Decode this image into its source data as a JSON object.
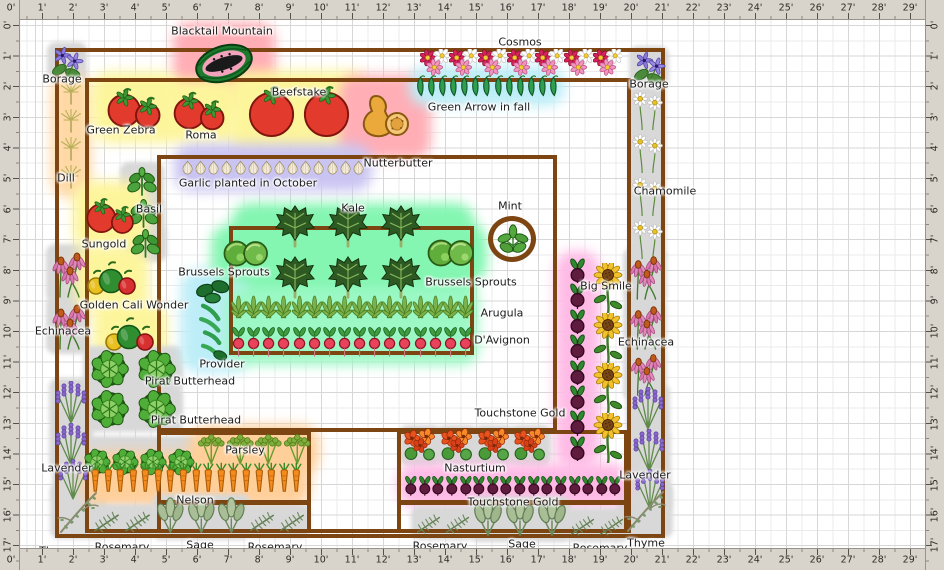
{
  "rulers": {
    "unit": "feet",
    "top": [
      "0'",
      "1'",
      "2'",
      "3'",
      "4'",
      "5'",
      "6'",
      "7'",
      "8'",
      "9'",
      "10'",
      "11'",
      "12'",
      "13'",
      "14'",
      "15'",
      "16'",
      "17'",
      "18'",
      "19'",
      "20'",
      "21'",
      "22'",
      "23'",
      "24'",
      "25'",
      "26'",
      "27'",
      "28'",
      "29'"
    ],
    "bottom": [
      "0'",
      "1'",
      "2'",
      "3'",
      "4'",
      "5'",
      "6'",
      "7'",
      "8'",
      "9'",
      "10'",
      "11'",
      "12'",
      "13'",
      "14'",
      "15'",
      "16'",
      "17'",
      "18'",
      "19'",
      "20'",
      "21'",
      "22'",
      "23'",
      "24'",
      "25'",
      "26'",
      "27'",
      "28'",
      "29'"
    ],
    "left": [
      "0'",
      "1'",
      "2'",
      "3'",
      "4'",
      "5'",
      "6'",
      "7'",
      "8'",
      "9'",
      "10'",
      "11'",
      "12'",
      "13'",
      "14'",
      "15'",
      "16'",
      "17'"
    ],
    "right": [
      "0'",
      "1'",
      "2'",
      "3'",
      "4'",
      "5'",
      "6'",
      "7'",
      "8'",
      "9'",
      "10'",
      "11'",
      "12'",
      "13'",
      "14'",
      "15'",
      "16'",
      "17'"
    ]
  },
  "colors": {
    "bed_border": "#7c4512",
    "ruler_bg": "#d8d4cb",
    "grid_minor": "#ebebeb",
    "grid_major": "#d7d7d7",
    "label_text": "#1c1c1c",
    "footprint": "#d8d8d8"
  },
  "beds": [
    {
      "name": "outer-bed",
      "x": 55,
      "y": 48,
      "w": 610,
      "h": 490
    },
    {
      "name": "main-bed",
      "x": 85,
      "y": 78,
      "w": 546,
      "h": 455
    },
    {
      "name": "center-bed",
      "x": 157,
      "y": 155,
      "w": 400,
      "h": 277
    },
    {
      "name": "salad-bed",
      "x": 229,
      "y": 226,
      "w": 245,
      "h": 129
    },
    {
      "name": "carrot-parsley-bed",
      "x": 157,
      "y": 431,
      "w": 154,
      "h": 102
    },
    {
      "name": "nasturtium-bed",
      "x": 397,
      "y": 430,
      "w": 231,
      "h": 103
    },
    {
      "name": "mint-pot",
      "x": 488,
      "y": 216,
      "w": 48,
      "h": 46,
      "shape": "circle"
    },
    {
      "name": "bed-divider",
      "x": 157,
      "y": 500,
      "w": 154,
      "h": 5,
      "shape": "line"
    },
    {
      "name": "bed-divider",
      "x": 397,
      "y": 500,
      "w": 231,
      "h": 5,
      "shape": "line"
    }
  ],
  "zones": [
    {
      "name": "kale-zone",
      "x": 232,
      "y": 203,
      "w": 242,
      "h": 102,
      "color": "#84f6b2"
    }
  ],
  "plants": [
    {
      "name": "borage",
      "icon": "borage",
      "x": 50,
      "y": 45,
      "w": 34,
      "h": 36,
      "fp": 1
    },
    {
      "name": "dill",
      "icon": "dill",
      "x": 57,
      "y": 80,
      "w": 28,
      "h": 112,
      "count": 4,
      "dir": "v",
      "glow": "#ffd8a6",
      "gp": 6
    },
    {
      "name": "echinacea",
      "icon": "echinacea",
      "x": 49,
      "y": 247,
      "w": 38,
      "h": 52,
      "fp": 1
    },
    {
      "name": "echinacea",
      "icon": "echinacea",
      "x": 49,
      "y": 299,
      "w": 38,
      "h": 52,
      "fp": 1
    },
    {
      "name": "lavender",
      "icon": "lavender",
      "x": 52,
      "y": 381,
      "w": 38,
      "h": 44,
      "fp": 1
    },
    {
      "name": "lavender",
      "icon": "lavender",
      "x": 52,
      "y": 423,
      "w": 38,
      "h": 44,
      "fp": 1
    },
    {
      "name": "lavender",
      "icon": "lavender",
      "x": 55,
      "y": 459,
      "w": 36,
      "h": 42,
      "fp": 1
    },
    {
      "name": "thyme",
      "icon": "thyme",
      "x": 53,
      "y": 486,
      "w": 50,
      "h": 50,
      "fp": 1
    },
    {
      "name": "blacktail-mountain-watermelon",
      "icon": "watermelon",
      "x": 190,
      "y": 39,
      "w": 68,
      "h": 49,
      "glow": "#ffaeb6",
      "gp": 17
    },
    {
      "name": "green-zebra-tomatoes",
      "icon": "tomato2",
      "x": 102,
      "y": 83,
      "w": 66,
      "h": 49,
      "glow": "#fdf59c",
      "gp": 11
    },
    {
      "name": "roma-tomatoes",
      "icon": "tomato2",
      "x": 169,
      "y": 87,
      "w": 62,
      "h": 47,
      "glow": "#fdf59c",
      "gp": 8
    },
    {
      "name": "beefstake-tomatoes",
      "icon": "tomato2big",
      "x": 242,
      "y": 84,
      "w": 114,
      "h": 55,
      "glow": "#fdf59c",
      "gp": 13
    },
    {
      "name": "nutterbutter-squash",
      "icon": "butternut",
      "x": 354,
      "y": 90,
      "w": 62,
      "h": 54,
      "glow": "#ffaeb6",
      "gp": 15
    },
    {
      "name": "green-arrow-peas",
      "icon": "peas",
      "x": 415,
      "y": 72,
      "w": 144,
      "h": 28,
      "count": 13,
      "glow": "#bdeef8",
      "gp": 6
    },
    {
      "name": "cosmos",
      "icon": "cosmos",
      "x": 420,
      "y": 49,
      "w": 202,
      "h": 27,
      "count": 7
    },
    {
      "name": "borage",
      "icon": "borage",
      "x": 632,
      "y": 49,
      "w": 34,
      "h": 38,
      "fp": 1
    },
    {
      "name": "chamomile",
      "icon": "chamomile",
      "x": 632,
      "y": 87,
      "w": 31,
      "h": 172,
      "count": 4,
      "dir": "v",
      "fp": 1
    },
    {
      "name": "echinacea",
      "icon": "echinacea",
      "x": 626,
      "y": 251,
      "w": 38,
      "h": 50,
      "fp": 1
    },
    {
      "name": "echinacea",
      "icon": "echinacea",
      "x": 626,
      "y": 301,
      "w": 38,
      "h": 50,
      "fp": 1
    },
    {
      "name": "echinacea",
      "icon": "echinacea",
      "x": 626,
      "y": 349,
      "w": 38,
      "h": 48,
      "fp": 1
    },
    {
      "name": "lavender",
      "icon": "lavender",
      "x": 629,
      "y": 387,
      "w": 38,
      "h": 44,
      "fp": 1
    },
    {
      "name": "lavender",
      "icon": "lavender",
      "x": 630,
      "y": 429,
      "w": 38,
      "h": 44,
      "fp": 1
    },
    {
      "name": "lavender",
      "icon": "lavender",
      "x": 632,
      "y": 469,
      "w": 36,
      "h": 42,
      "fp": 1
    },
    {
      "name": "thyme",
      "icon": "thyme",
      "x": 620,
      "y": 485,
      "w": 50,
      "h": 50,
      "fp": 1
    },
    {
      "name": "basil",
      "icon": "basil",
      "x": 123,
      "y": 165,
      "w": 38,
      "h": 32,
      "fp": 1
    },
    {
      "name": "basil",
      "icon": "basil",
      "x": 125,
      "y": 197,
      "w": 37,
      "h": 32,
      "fp": 1
    },
    {
      "name": "basil",
      "icon": "basil",
      "x": 127,
      "y": 227,
      "w": 37,
      "h": 32,
      "fp": 1
    },
    {
      "name": "sungold-tomatoes",
      "icon": "tomato2",
      "x": 83,
      "y": 191,
      "w": 56,
      "h": 49,
      "glow": "#fdf59c",
      "gp": 10
    },
    {
      "name": "golden-cali-wonder-peppers",
      "icon": "peppers",
      "x": 86,
      "y": 257,
      "w": 52,
      "h": 44,
      "glow": "#fdf59c",
      "gp": 11
    },
    {
      "name": "golden-cali-wonder-peppers",
      "icon": "peppers",
      "x": 104,
      "y": 313,
      "w": 52,
      "h": 44,
      "glow": "#fdf59c",
      "gp": 11
    },
    {
      "name": "pirat-butterhead-lettuce",
      "icon": "lettuce",
      "x": 86,
      "y": 349,
      "w": 94,
      "h": 40,
      "count": 2,
      "fp": 1
    },
    {
      "name": "pirat-butterhead-lettuce",
      "icon": "lettuce",
      "x": 86,
      "y": 389,
      "w": 94,
      "h": 40,
      "count": 2,
      "fp": 1
    },
    {
      "name": "pirat-butterhead-lettuce",
      "icon": "lettuce",
      "x": 83,
      "y": 439,
      "w": 112,
      "h": 46,
      "count": 4,
      "fp": 1
    },
    {
      "name": "parsley",
      "icon": "parsley",
      "x": 197,
      "y": 433,
      "w": 114,
      "h": 33,
      "count": 4,
      "glow": "#ffcf9a",
      "gp": 8
    },
    {
      "name": "nelson-carrots",
      "icon": "carrot",
      "x": 89,
      "y": 459,
      "w": 214,
      "h": 41,
      "count": 17,
      "glow": "#ffcf9a",
      "gp": 7
    },
    {
      "name": "provider-beans",
      "icon": "beans",
      "x": 191,
      "y": 279,
      "w": 47,
      "h": 84,
      "glow": "#bdeef8",
      "gp": 10
    },
    {
      "name": "garlic",
      "icon": "garlic",
      "x": 181,
      "y": 151,
      "w": 184,
      "h": 33,
      "count": 14,
      "glow": "#cac4f2",
      "gp": 7
    },
    {
      "name": "kale",
      "icon": "kale",
      "x": 270,
      "y": 202,
      "w": 50,
      "h": 46
    },
    {
      "name": "kale",
      "icon": "kale",
      "x": 323,
      "y": 202,
      "w": 50,
      "h": 46
    },
    {
      "name": "kale",
      "icon": "kale",
      "x": 376,
      "y": 202,
      "w": 50,
      "h": 46
    },
    {
      "name": "kale",
      "icon": "kale",
      "x": 270,
      "y": 253,
      "w": 50,
      "h": 46
    },
    {
      "name": "kale",
      "icon": "kale",
      "x": 323,
      "y": 253,
      "w": 50,
      "h": 46
    },
    {
      "name": "kale",
      "icon": "kale",
      "x": 376,
      "y": 253,
      "w": 50,
      "h": 46
    },
    {
      "name": "brussels-sprouts",
      "icon": "brussels",
      "x": 223,
      "y": 237,
      "w": 46,
      "h": 33,
      "glow": "#84f6b2",
      "gp": 12
    },
    {
      "name": "brussels-sprouts",
      "icon": "brussels",
      "x": 427,
      "y": 236,
      "w": 48,
      "h": 34,
      "glow": "#84f6b2",
      "gp": 12
    },
    {
      "name": "mint",
      "icon": "mintplant",
      "x": 496,
      "y": 223,
      "w": 34,
      "h": 34
    },
    {
      "name": "arugula",
      "icon": "arugula",
      "x": 231,
      "y": 293,
      "w": 242,
      "h": 34,
      "count": 16,
      "glow": "#9bf8c4",
      "gp": 6
    },
    {
      "name": "davignon-radishes",
      "icon": "radish",
      "x": 231,
      "y": 326,
      "w": 242,
      "h": 33,
      "count": 16,
      "glow": "#9bf8c4",
      "gp": 6
    },
    {
      "name": "touchstone-gold-beets",
      "icon": "beet",
      "x": 562,
      "y": 258,
      "w": 31,
      "h": 203,
      "count": 8,
      "dir": "v",
      "glow": "#ffbae6",
      "gp": 7
    },
    {
      "name": "big-smile-sunflowers",
      "icon": "sunflower",
      "x": 590,
      "y": 263,
      "w": 36,
      "h": 200,
      "count": 4,
      "dir": "v"
    },
    {
      "name": "nasturtium",
      "icon": "nasturtium",
      "x": 402,
      "y": 428,
      "w": 36,
      "h": 35,
      "fp": 1
    },
    {
      "name": "nasturtium",
      "icon": "nasturtium",
      "x": 439,
      "y": 428,
      "w": 36,
      "h": 35,
      "fp": 1
    },
    {
      "name": "nasturtium",
      "icon": "nasturtium",
      "x": 476,
      "y": 428,
      "w": 36,
      "h": 35,
      "fp": 1
    },
    {
      "name": "nasturtium",
      "icon": "nasturtium",
      "x": 512,
      "y": 428,
      "w": 36,
      "h": 35,
      "fp": 1
    },
    {
      "name": "touchstone-gold-beets",
      "icon": "beet",
      "x": 404,
      "y": 469,
      "w": 218,
      "h": 33,
      "count": 16,
      "glow": "#ffbae6",
      "gp": 6
    },
    {
      "name": "rosemary",
      "icon": "rosemary",
      "x": 91,
      "y": 507,
      "w": 62,
      "h": 28,
      "count": 2,
      "fp": 1
    },
    {
      "name": "sage",
      "icon": "sage",
      "x": 155,
      "y": 497,
      "w": 92,
      "h": 40,
      "count": 3,
      "fp": 1
    },
    {
      "name": "rosemary",
      "icon": "rosemary",
      "x": 247,
      "y": 507,
      "w": 60,
      "h": 28,
      "count": 2,
      "fp": 1
    },
    {
      "name": "rosemary",
      "icon": "rosemary",
      "x": 414,
      "y": 509,
      "w": 58,
      "h": 28,
      "count": 2,
      "fp": 1
    },
    {
      "name": "sage",
      "icon": "sage",
      "x": 472,
      "y": 499,
      "w": 96,
      "h": 40,
      "count": 3,
      "fp": 1
    },
    {
      "name": "rosemary",
      "icon": "rosemary",
      "x": 568,
      "y": 511,
      "w": 58,
      "h": 28,
      "count": 2,
      "fp": 1
    }
  ],
  "labels": [
    {
      "text": "Blacktail Mountain",
      "x": 222,
      "y": 31
    },
    {
      "text": "Borage",
      "x": 62,
      "y": 79
    },
    {
      "text": "Cosmos",
      "x": 520,
      "y": 42
    },
    {
      "text": "Borage",
      "x": 649,
      "y": 84
    },
    {
      "text": "Green Zebra",
      "x": 121,
      "y": 130
    },
    {
      "text": "Roma",
      "x": 201,
      "y": 135
    },
    {
      "text": "Beefstake",
      "x": 299,
      "y": 92
    },
    {
      "text": "Green Arrow in fall",
      "x": 479,
      "y": 107
    },
    {
      "text": "Nutterbutter",
      "x": 398,
      "y": 163
    },
    {
      "text": "Dill",
      "x": 66,
      "y": 178
    },
    {
      "text": "Basil",
      "x": 149,
      "y": 209
    },
    {
      "text": "Sungold",
      "x": 104,
      "y": 244
    },
    {
      "text": "Garlic planted in October",
      "x": 248,
      "y": 183
    },
    {
      "text": "Kale",
      "x": 353,
      "y": 208
    },
    {
      "text": "Mint",
      "x": 510,
      "y": 206
    },
    {
      "text": "Brussels Sprouts",
      "x": 224,
      "y": 272
    },
    {
      "text": "Brussels Sprouts",
      "x": 471,
      "y": 282
    },
    {
      "text": "Chamomile",
      "x": 665,
      "y": 191
    },
    {
      "text": "Golden Cali Wonder",
      "x": 134,
      "y": 305
    },
    {
      "text": "Echinacea",
      "x": 63,
      "y": 331
    },
    {
      "text": "Echinacea",
      "x": 646,
      "y": 342
    },
    {
      "text": "Arugula",
      "x": 502,
      "y": 313
    },
    {
      "text": "D'Avignon",
      "x": 502,
      "y": 340
    },
    {
      "text": "Provider",
      "x": 222,
      "y": 364
    },
    {
      "text": "Pirat Butterhead",
      "x": 190,
      "y": 381
    },
    {
      "text": "Pirat Butterhead",
      "x": 196,
      "y": 420
    },
    {
      "text": "Touchstone Gold",
      "x": 520,
      "y": 413
    },
    {
      "text": "Big Smile",
      "x": 606,
      "y": 286
    },
    {
      "text": "Lavender",
      "x": 67,
      "y": 468
    },
    {
      "text": "Lavender",
      "x": 645,
      "y": 475
    },
    {
      "text": "Parsley",
      "x": 245,
      "y": 450
    },
    {
      "text": "Nelson",
      "x": 195,
      "y": 500
    },
    {
      "text": "Nasturtium",
      "x": 475,
      "y": 468
    },
    {
      "text": "Touchstone Gold",
      "x": 513,
      "y": 502
    },
    {
      "text": "Rosemary",
      "x": 122,
      "y": 547
    },
    {
      "text": "Sage",
      "x": 200,
      "y": 545
    },
    {
      "text": "Rosemary",
      "x": 275,
      "y": 547
    },
    {
      "text": "Thyme",
      "x": 58,
      "y": 551
    },
    {
      "text": "Rosemary",
      "x": 440,
      "y": 546
    },
    {
      "text": "Sage",
      "x": 522,
      "y": 544
    },
    {
      "text": "Rosemary",
      "x": 600,
      "y": 548
    },
    {
      "text": "Thyme",
      "x": 646,
      "y": 543
    }
  ]
}
